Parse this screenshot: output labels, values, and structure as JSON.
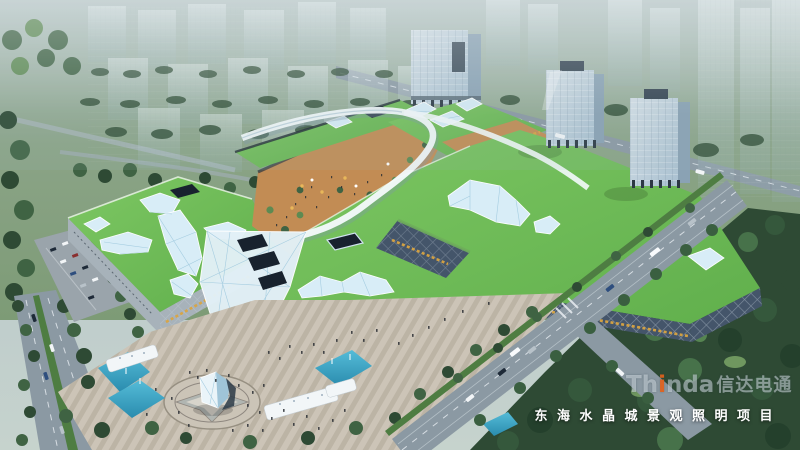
{
  "overlay": {
    "title": "东海水晶城景观照明项目",
    "watermark": {
      "prefix": "Th",
      "accent": "i",
      "suffix": "nda",
      "cjk": "信达电通"
    }
  },
  "colors": {
    "sky": "#b4c4cd",
    "field": "#83a07c",
    "treeDark": "#2e4a34",
    "treeMid": "#3f6343",
    "treeLight": "#5d8a52",
    "roofGreen": "#71c159",
    "crystal": "#d8edf7",
    "crystalEdge": "#9fc9de",
    "facadeDark": "#232d39",
    "gold": "#d9a441",
    "towerGlass": "#c6d7e1",
    "towerSide": "#8aa2b4",
    "road": "#8b99a3",
    "median": "#4e7d42",
    "plaza": "#c9c1b4",
    "plazaStripe": "#a89e90",
    "water": "#35a0c4",
    "people": "#2b2f35",
    "title": "#ffffff",
    "watermark": "rgba(226,234,239,0.5)",
    "accentOrange": "#e2611c"
  }
}
